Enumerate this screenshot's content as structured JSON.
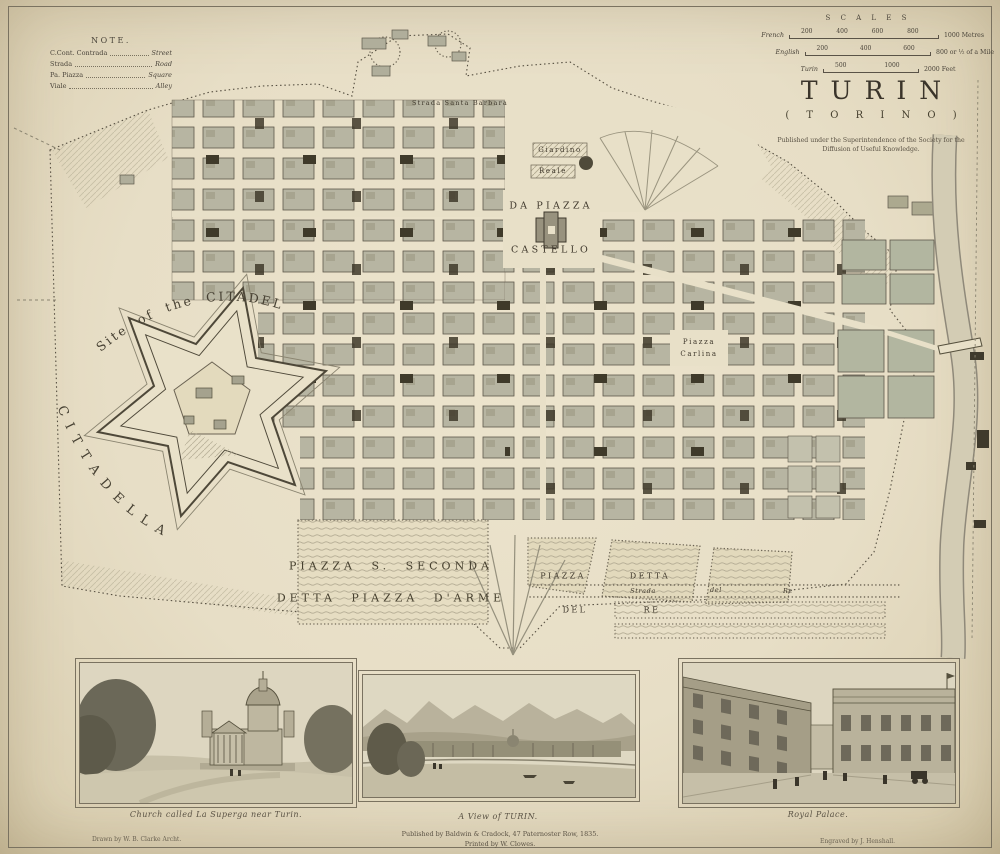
{
  "colors": {
    "paper": "#e8dfc6",
    "ink": "#3c362b",
    "block_fill": "#b7b5a2",
    "river": "#cdc6ae",
    "garden": "#b2b6a0",
    "dark_block": "#3f3a2a"
  },
  "note": {
    "heading": "NOTE.",
    "rows": [
      {
        "term": "C.Cont. Contrada",
        "def": "Street"
      },
      {
        "term": "Strada",
        "def": "Road"
      },
      {
        "term": "Pa. Piazza",
        "def": "Square"
      },
      {
        "term": "Viale",
        "def": "Alley"
      }
    ]
  },
  "scales": {
    "heading": "S C A L E S",
    "rows": [
      {
        "name": "French",
        "ticks": "200 400 600 800",
        "end": "1000 Metres"
      },
      {
        "name": "English",
        "ticks": "200 400 600",
        "end": "800  or ½ of a Mile"
      },
      {
        "name": "Turin",
        "ticks": "500 1000",
        "end": "2000 Feet"
      }
    ]
  },
  "title_block": {
    "title": "TURIN",
    "subtitle": "( T O R I N O )",
    "imprint_line1": "Published under the Superintendence of the Society for the",
    "imprint_line2": "Diffusion of Useful Knowledge."
  },
  "map": {
    "labels": {
      "strada_santa_barbara": "Strada   Santa   Barbara",
      "giardino": "Giardino",
      "reale": "Reale",
      "da_piazza": "DA PIAZZA",
      "castello": "CASTELLO",
      "piazza_carlina_1": "Piazza",
      "piazza_carlina_2": "Carlina",
      "piazza_s_seconda": "PIAZZA  S.  SECONDA",
      "detta_piazza_darme": "DETTA  PIAZZA  D'ARME",
      "piazza_detta_1": "PIAZZA",
      "piazza_detta_2": "DETTA",
      "piazza_detta_3": "DEL",
      "piazza_detta_4": "RE",
      "strada_del_re_1": "Strada",
      "strada_del_re_2": "del",
      "strada_del_re_3": "Re",
      "site_of_citadel": "Site  of  the  CITADEL",
      "cittadella": "CITTADELLA"
    }
  },
  "vignettes": [
    {
      "caption": "Church called La Superga near Turin."
    },
    {
      "caption": "A View of TURIN."
    },
    {
      "caption": "Royal Palace."
    }
  ],
  "credits": {
    "drawn": "Drawn by W. B. Clarke Archt.",
    "engraved": "Engraved by J. Henshall.",
    "published": "Published by Baldwin & Cradock, 47 Paternoster Row, 1835.",
    "printed": "Printed by W. Clowes."
  }
}
